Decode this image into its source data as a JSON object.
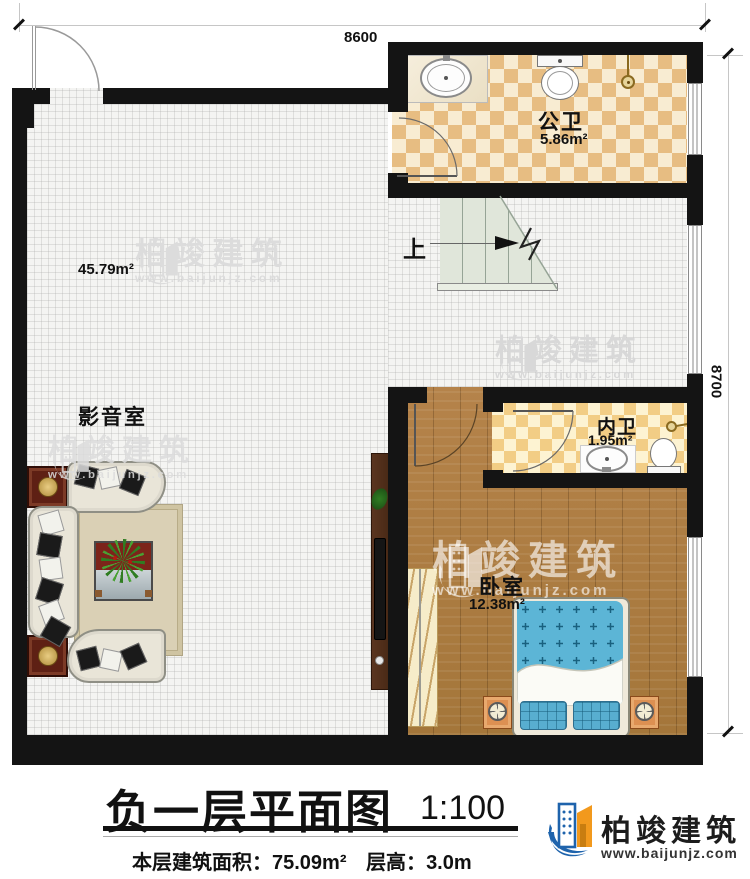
{
  "plan": {
    "dimensions": {
      "top": "8600",
      "right": "8700"
    },
    "rooms": {
      "media": {
        "name": "影音室",
        "area": "45.79m²"
      },
      "public_bath": {
        "name": "公卫",
        "area": "5.86m²"
      },
      "inner_bath": {
        "name": "内卫",
        "area": "1.95m²"
      },
      "bedroom": {
        "name": "卧室",
        "area": "12.38m²"
      },
      "stairs": {
        "direction_label": "上"
      }
    }
  },
  "title_block": {
    "title": "负一层平面图",
    "scale": "1:100",
    "area_label": "本层建筑面积：",
    "area_value": "75.09m²",
    "height_label": "层高：",
    "height_value": "3.0m"
  },
  "brand": {
    "name": "柏竣建筑",
    "url": "www.baijunjz.com"
  },
  "colors": {
    "wall": "#141414",
    "brand_blue": "#1e63ac",
    "brand_orange": "#f2991d",
    "tile_tan": "#e7bd82",
    "tile_cream": "#f8ecd2",
    "wood": "#ad7c3f",
    "stair_green": "#e0e6da",
    "bed_blue": "#5cb5d6",
    "side_table_red": "#5e2014",
    "watermark_gray": "#dcdcdc"
  }
}
